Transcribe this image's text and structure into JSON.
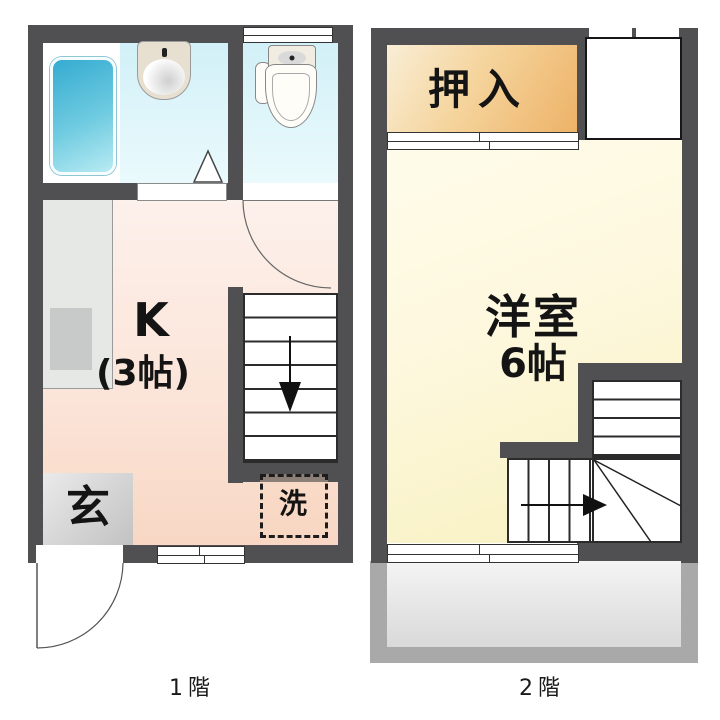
{
  "floor1": {
    "caption": "1階",
    "kitchen": {
      "label": "K",
      "size": "(3帖)"
    },
    "entrance": {
      "label": "玄"
    },
    "laundry": {
      "label": "洗"
    }
  },
  "floor2": {
    "caption": "2階",
    "closet": {
      "label": "押入"
    },
    "room": {
      "label": "洋室",
      "size": "6帖"
    }
  },
  "fixtures": [
    "bathtub",
    "sink",
    "toilet",
    "door-swing",
    "folding-door",
    "sliding-door",
    "staircase-down",
    "staircase-up",
    "washing-machine-space",
    "balcony"
  ],
  "colors": {
    "wall": "#505052",
    "line": "#2b2b2b",
    "tub_start": "#35abd1",
    "tub_end": "#b8ebf3",
    "washroom_bg": "#d2f0f8",
    "kitchen_start": "#fdf2ed",
    "kitchen_end": "#f8d7c4",
    "entrance_start": "#eaeaea",
    "entrance_end": "#c2c2c2",
    "closet_start": "#f9eed6",
    "closet_end": "#edb267",
    "room_start": "#fffdf0",
    "room_end": "#f8f0bf",
    "counter": "#e5e8e4",
    "counter_inner": "#c7cac8",
    "balcony_frame": "#a9a9a9",
    "balcony_floor_start": "#f4f4f4",
    "balcony_floor_end": "#d9d9d9"
  }
}
